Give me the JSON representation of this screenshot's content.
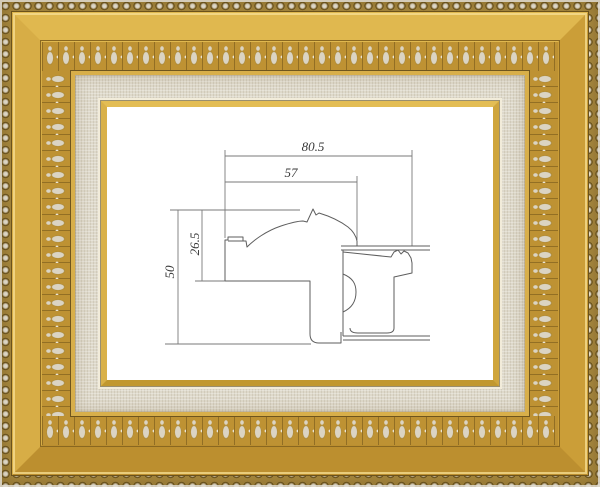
{
  "image": {
    "description": "Ornate gold picture frame with beaded edge, egg-and-dart ornament band and linen liner, displaying a technical cross-section drawing of the frame moulding",
    "frame": {
      "material": "gold",
      "liner": "linen",
      "colors": {
        "gold_bright": "#E3BC55",
        "gold_mid": "#C99B35",
        "gold_dark": "#9C7526",
        "bead_silver": "#D8D1C0",
        "ornament_silver": "#D6CFBE",
        "linen": "#DED9CB",
        "fillet_cream": "#F4EDD6",
        "paper_white": "#FFFFFF"
      }
    }
  },
  "diagram": {
    "type": "moulding-cross-section",
    "units": "mm",
    "line_color": "#6E6E6E",
    "text_color": "#3A3A3A",
    "dimensions": [
      {
        "name": "overall-width",
        "label": "80.5",
        "orientation": "horizontal"
      },
      {
        "name": "face-width",
        "label": "57",
        "orientation": "horizontal"
      },
      {
        "name": "face-height",
        "label": "26.5",
        "orientation": "vertical"
      },
      {
        "name": "overall-height",
        "label": "50",
        "orientation": "vertical"
      }
    ]
  }
}
